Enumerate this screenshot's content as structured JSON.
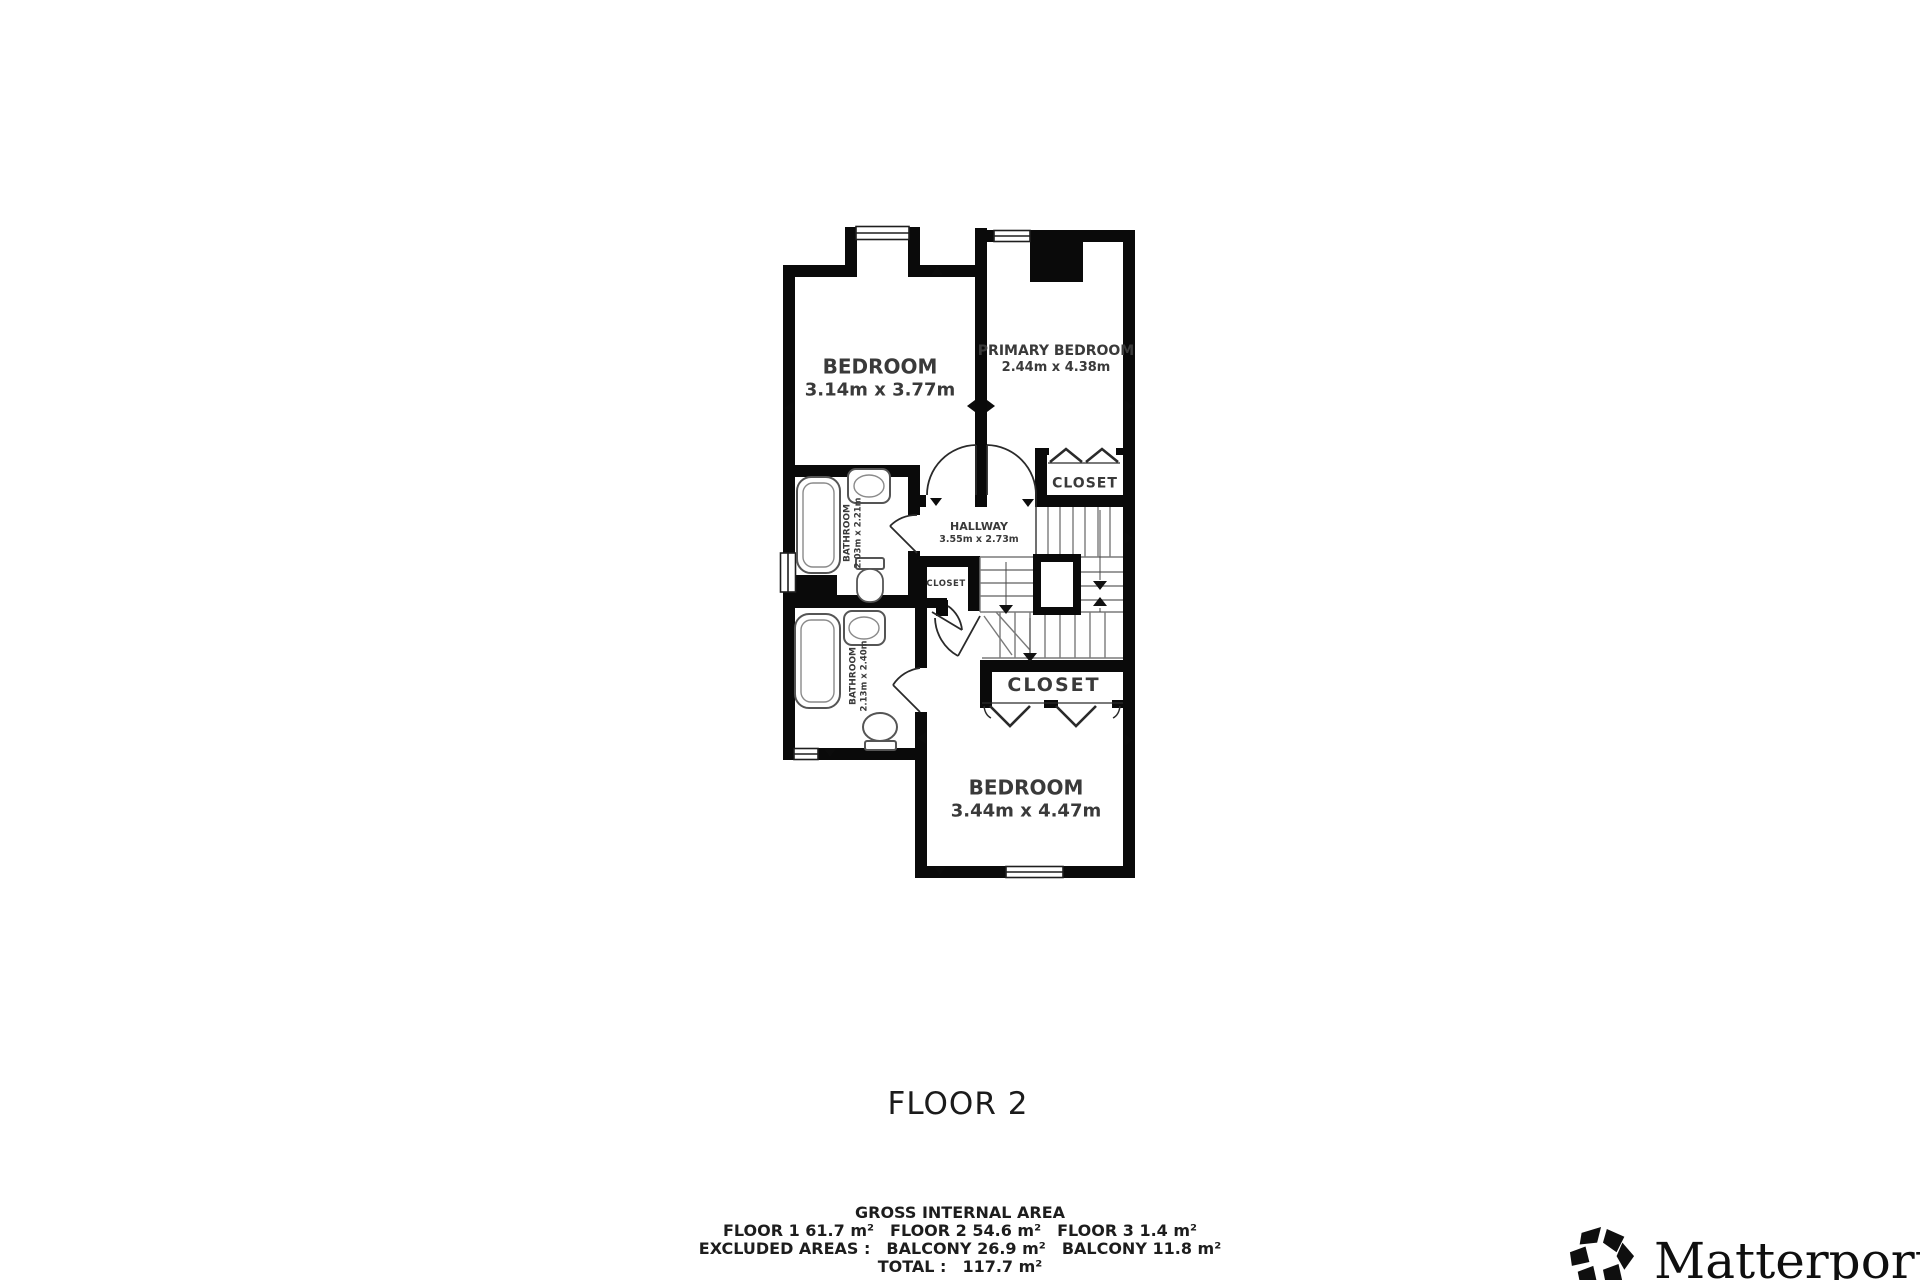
{
  "plan": {
    "title": "FLOOR 2",
    "rooms": {
      "bedroom_top": {
        "name": "BEDROOM",
        "dims": "3.14m x 3.77m"
      },
      "primary_bedroom": {
        "name": "PRIMARY BEDROOM",
        "dims": "2.44m x 4.38m"
      },
      "hallway": {
        "name": "HALLWAY",
        "dims": "3.55m x 2.73m"
      },
      "bathroom_upper": {
        "name": "BATHROOM",
        "dims": "2.03m x 2.21m"
      },
      "bathroom_lower": {
        "name": "BATHROOM",
        "dims": "2.13m x 2.40m"
      },
      "bedroom_bottom": {
        "name": "BEDROOM",
        "dims": "3.44m x 4.47m"
      },
      "closet_top_right": {
        "name": "CLOSET"
      },
      "closet_small": {
        "name": "CLOSET"
      },
      "closet_bottom": {
        "name": "CLOSET"
      }
    },
    "colors": {
      "wall": "#0a0a0a",
      "label": "#3a3a3a",
      "fixture_outline": "#555555",
      "stair_tread": "#777777"
    }
  },
  "summary": {
    "heading": "GROSS INTERNAL AREA",
    "floors_line": {
      "floor1": "FLOOR 1 61.7 m²",
      "floor2": "FLOOR 2 54.6 m²",
      "floor3": "FLOOR 3 1.4 m²"
    },
    "excluded_line": {
      "label": "EXCLUDED AREAS :",
      "balcony1": "BALCONY 26.9 m²",
      "balcony2": "BALCONY 11.8 m²"
    },
    "total_line": {
      "label": "TOTAL :",
      "value": "117.7 m²"
    }
  },
  "branding": {
    "name": "Matterport",
    "registered": "®"
  }
}
